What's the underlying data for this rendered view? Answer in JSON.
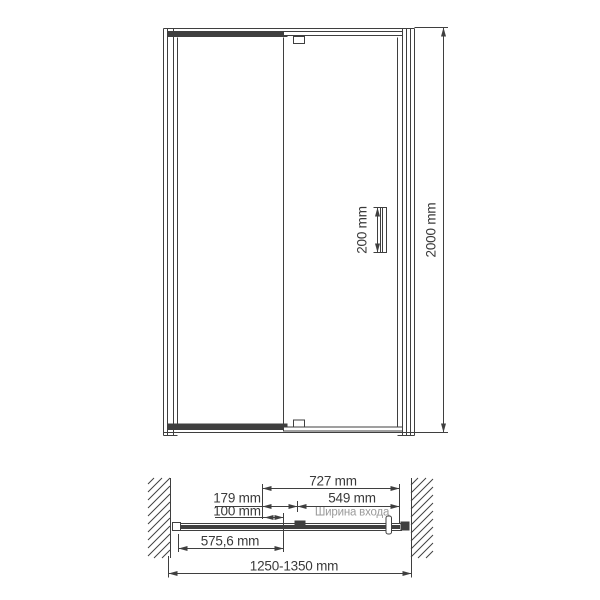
{
  "front_view": {
    "handle_height_label": "200 mm",
    "total_height_label": "2000 mm"
  },
  "plan_view": {
    "door_unit_width_label": "727 mm",
    "pivot_offset_label": "179 mm",
    "entrance_width_label": "549 mm",
    "adjust_label": "100 mm",
    "entrance_caption": "Ширина входа",
    "fixed_panel_width_label": "575,6 mm",
    "overall_width_label": "1250-1350 mm"
  },
  "colors": {
    "line": "#3f3f3f",
    "muted_text": "#9a9a9a",
    "background": "#ffffff"
  }
}
